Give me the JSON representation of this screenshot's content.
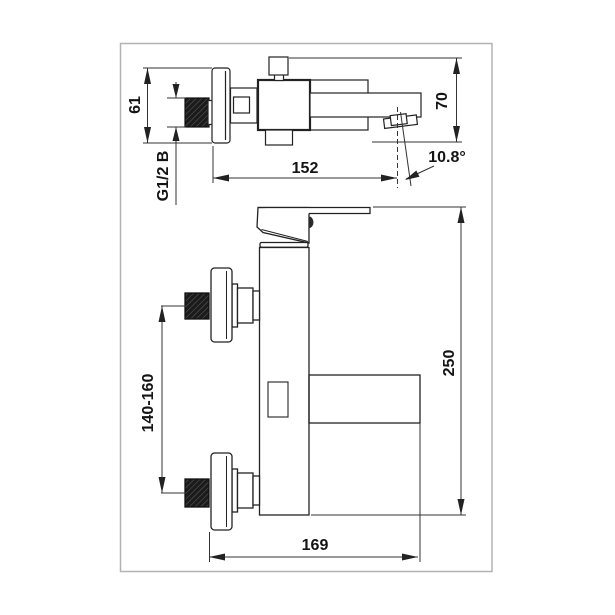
{
  "drawing": {
    "title": "bath-mixer-technical-drawing",
    "dimensions": {
      "escutcheon_diameter": "61",
      "thread_size": "G1/2 B",
      "spout_reach": "152",
      "spout_height": "70",
      "spout_angle": "10.8°",
      "inlet_spacing": "140-160",
      "overall_height": "250",
      "overall_depth": "169"
    },
    "colors": {
      "line": "#333333",
      "outline": "#222222",
      "text": "#141414",
      "page_border": "#b3b3b3",
      "thread_fill": "#1b1b1b"
    }
  }
}
